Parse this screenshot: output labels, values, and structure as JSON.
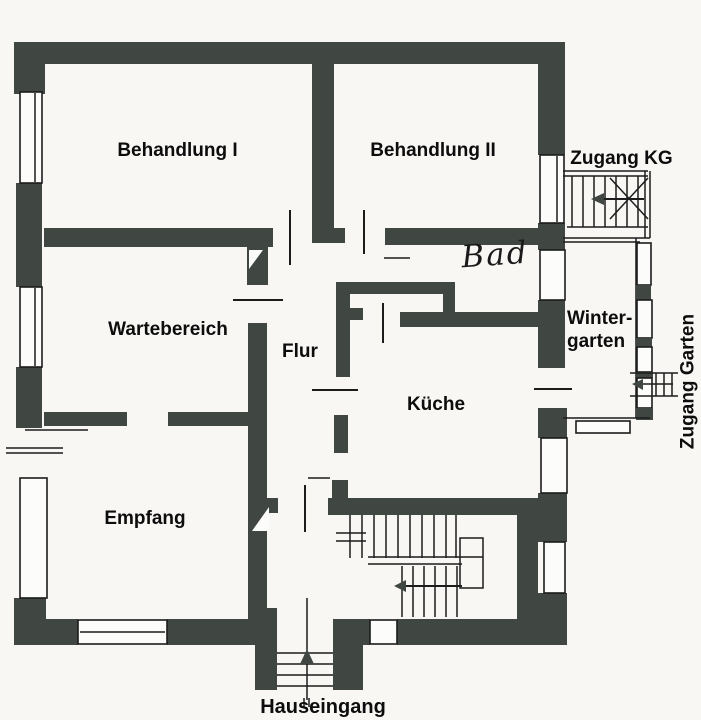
{
  "document": {
    "type": "floor-plan-drawing"
  },
  "colors": {
    "wall": "#404743",
    "line": "#1c1c1c",
    "paper": "#f8f7f4"
  },
  "rooms": {
    "behandlung1": {
      "label": "Behandlung I"
    },
    "behandlung2": {
      "label": "Behandlung II"
    },
    "wartebereich": {
      "label": "Wartebereich"
    },
    "flur": {
      "label": "Flur"
    },
    "bad": {
      "label": "Bad"
    },
    "kueche": {
      "label": "Küche"
    },
    "empfang": {
      "label": "Empfang"
    },
    "wintergarten": {
      "label_line1": "Winter-",
      "label_line2": "garten"
    }
  },
  "annotations": {
    "zugang_kg": {
      "label": "Zugang KG"
    },
    "zugang_garten": {
      "label": "Zugang Garten"
    },
    "hauseingang": {
      "label": "Hauseingang"
    }
  }
}
